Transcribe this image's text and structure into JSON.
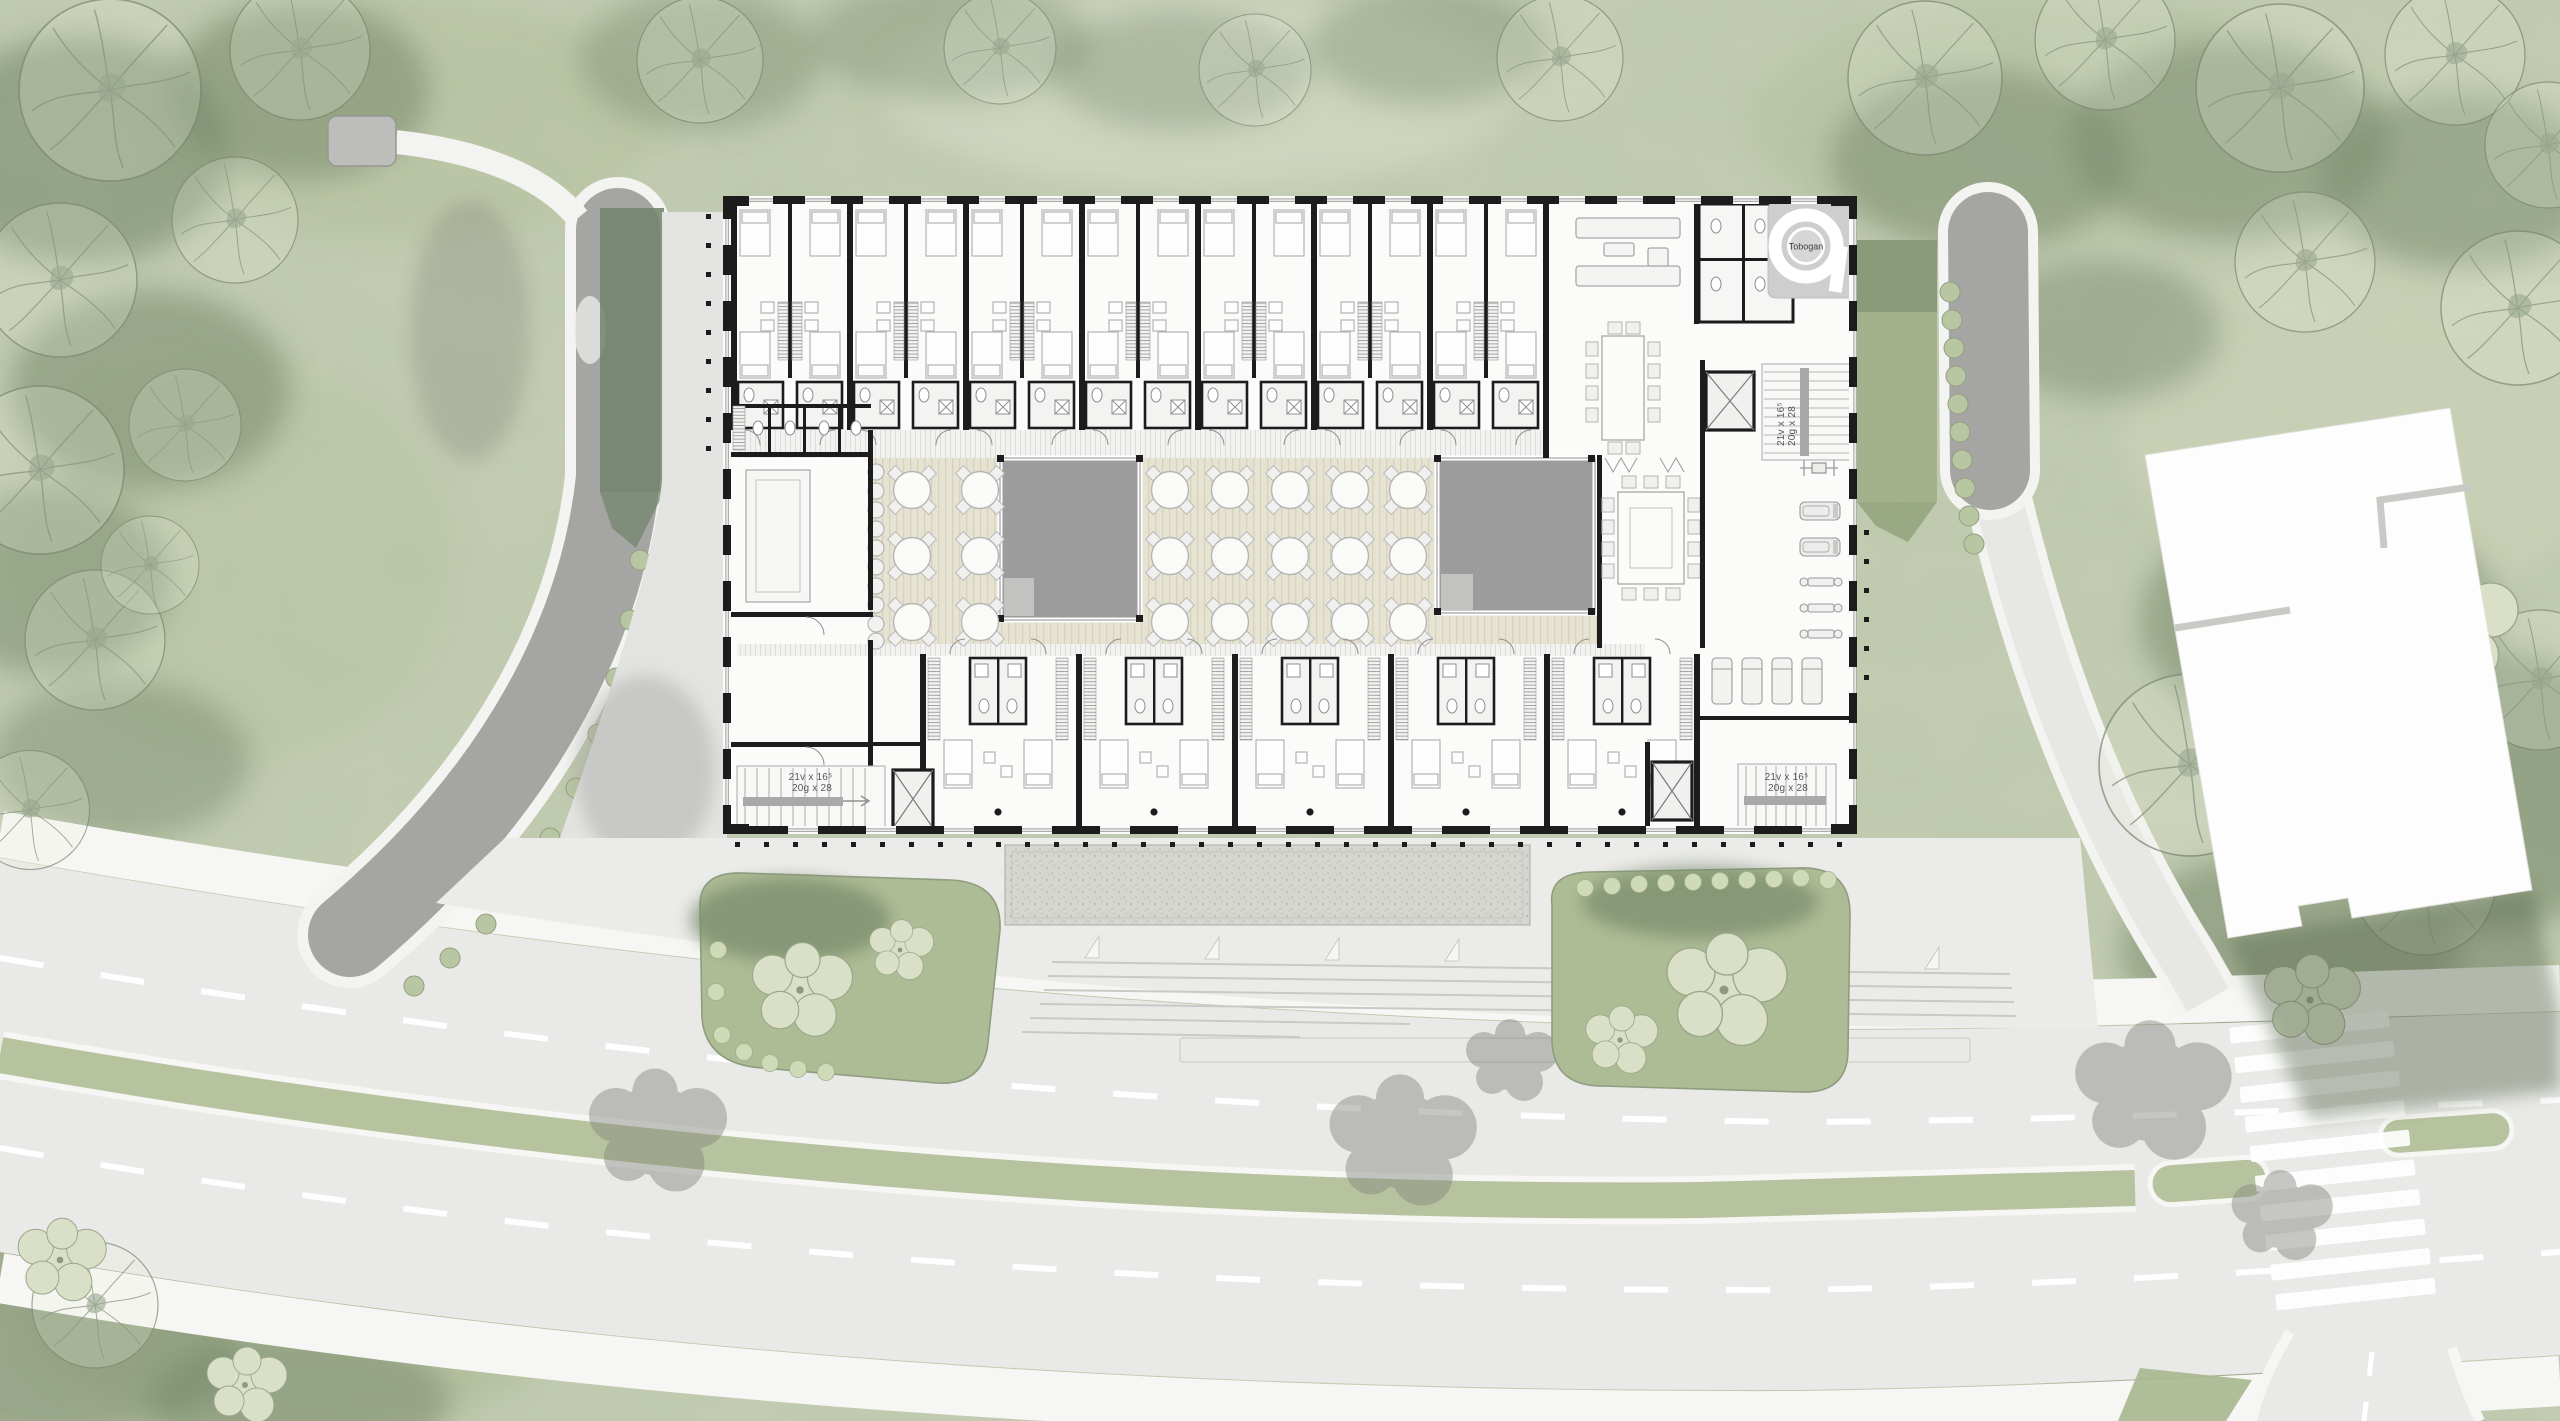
{
  "meta": {
    "type": "architectural-site-plan",
    "view": "ground-floor plan with landscape context"
  },
  "labels": {
    "slide": "Tobogan",
    "stair_note_line1": "21v x 16⁵",
    "stair_note_line2": "20g x 28"
  },
  "annotations": {
    "stair_cores": [
      "upper-right-core",
      "lower-left-core",
      "lower-right-core"
    ],
    "slide_location": "upper-right amenity block"
  },
  "palette": {
    "ground_green": "#c4cdb1",
    "canopy_dark": "#76886a",
    "lawn_green": "#a3b28c",
    "median_green": "#b7c39e",
    "road_gray": "#e9e9e7",
    "sidewalk_white": "#f6f6f4",
    "driveway_gray": "#a5a5a3",
    "wall_black": "#1c1c1c",
    "deck_beige": "#e7e3d3",
    "courtyard_void_gray": "#9c9c9c",
    "gravel_gray": "#d6d6d0",
    "neighbor_building_white": "#fdfdfd"
  },
  "counts": {
    "guest_room_modules_north": 7,
    "guest_room_modules_south": 5,
    "courtyard_voids": 2,
    "round_dining_tables": 21,
    "buffet_stools": 10,
    "meeting_table_seats": 14,
    "gym_loungers": 4,
    "crosswalk_stripes": 10,
    "driveway_hedge_bushes": 10
  }
}
